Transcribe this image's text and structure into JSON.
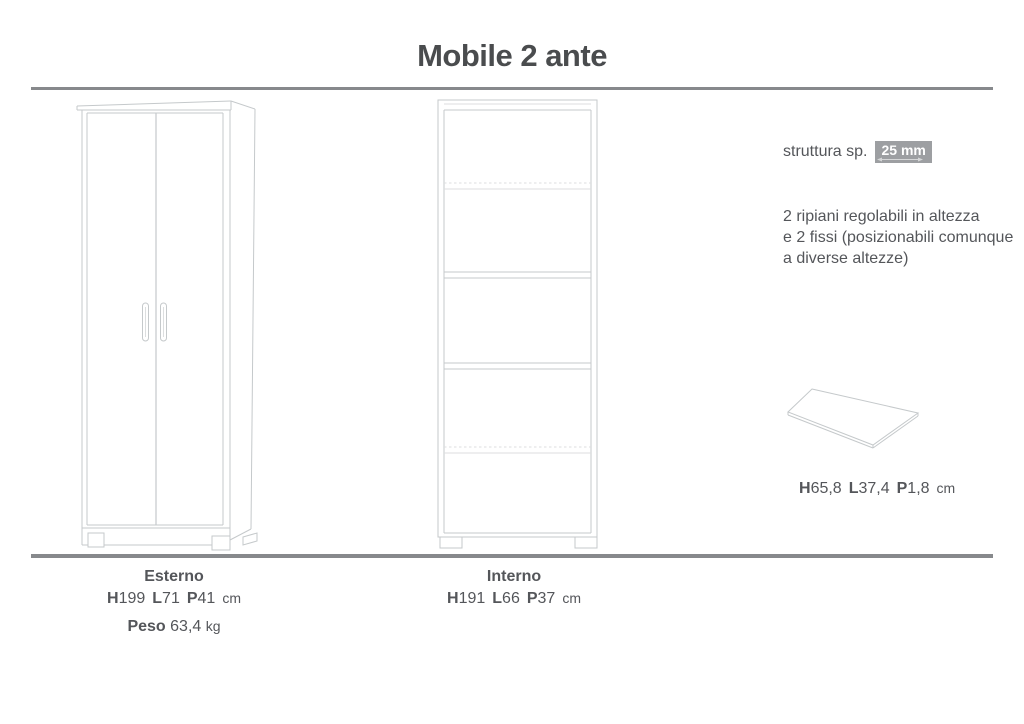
{
  "title": "Mobile 2 ante",
  "colors": {
    "text": "#54565a",
    "title": "#4a4c4e",
    "line_art": "#c5c9cb",
    "line_art_faint": "#dcdedf",
    "divider": "#87898c",
    "badge_bg": "#9d9fa2",
    "badge_text": "#ffffff"
  },
  "specs": {
    "structure": {
      "label": "struttura sp.",
      "value": "25 mm"
    },
    "shelves_note": {
      "line1": "2 ripiani regolabili in altezza",
      "line2": "e 2 fissi (posizionabili comunque",
      "line3": "a diverse altezze)"
    },
    "shelf_panel": {
      "dims": [
        {
          "k": "H",
          "v": "65,8"
        },
        {
          "k": "L",
          "v": "37,4"
        },
        {
          "k": "P",
          "v": "1,8"
        }
      ],
      "unit": "cm"
    }
  },
  "footer": {
    "esterno": {
      "heading": "Esterno",
      "dims": [
        {
          "k": "H",
          "v": "199"
        },
        {
          "k": "L",
          "v": "71"
        },
        {
          "k": "P",
          "v": "41"
        }
      ],
      "unit": "cm",
      "peso": {
        "label": "Peso",
        "value": "63,4",
        "unit": "kg"
      }
    },
    "interno": {
      "heading": "Interno",
      "dims": [
        {
          "k": "H",
          "v": "191"
        },
        {
          "k": "L",
          "v": "66"
        },
        {
          "k": "P",
          "v": "37"
        }
      ],
      "unit": "cm"
    }
  },
  "drawings": {
    "exterior": "two-door-cabinet-front-perspective",
    "interior": "cabinet-interior-with-4-shelves",
    "shelf_panel": "flat-shelf-panel-perspective"
  }
}
